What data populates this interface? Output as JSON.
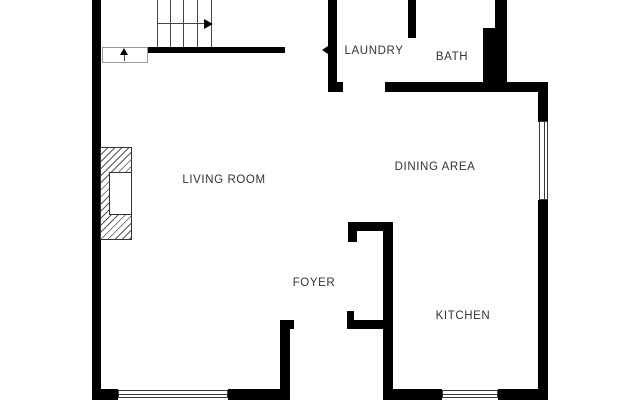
{
  "rooms": {
    "living_room": "LIVING ROOM",
    "dining_area": "DINING AREA",
    "laundry": "LAUNDRY",
    "bath": "BATH",
    "foyer": "FOYER",
    "kitchen": "KITCHEN"
  },
  "colors": {
    "wall": "#000000",
    "background": "#ffffff",
    "text": "#333333"
  }
}
